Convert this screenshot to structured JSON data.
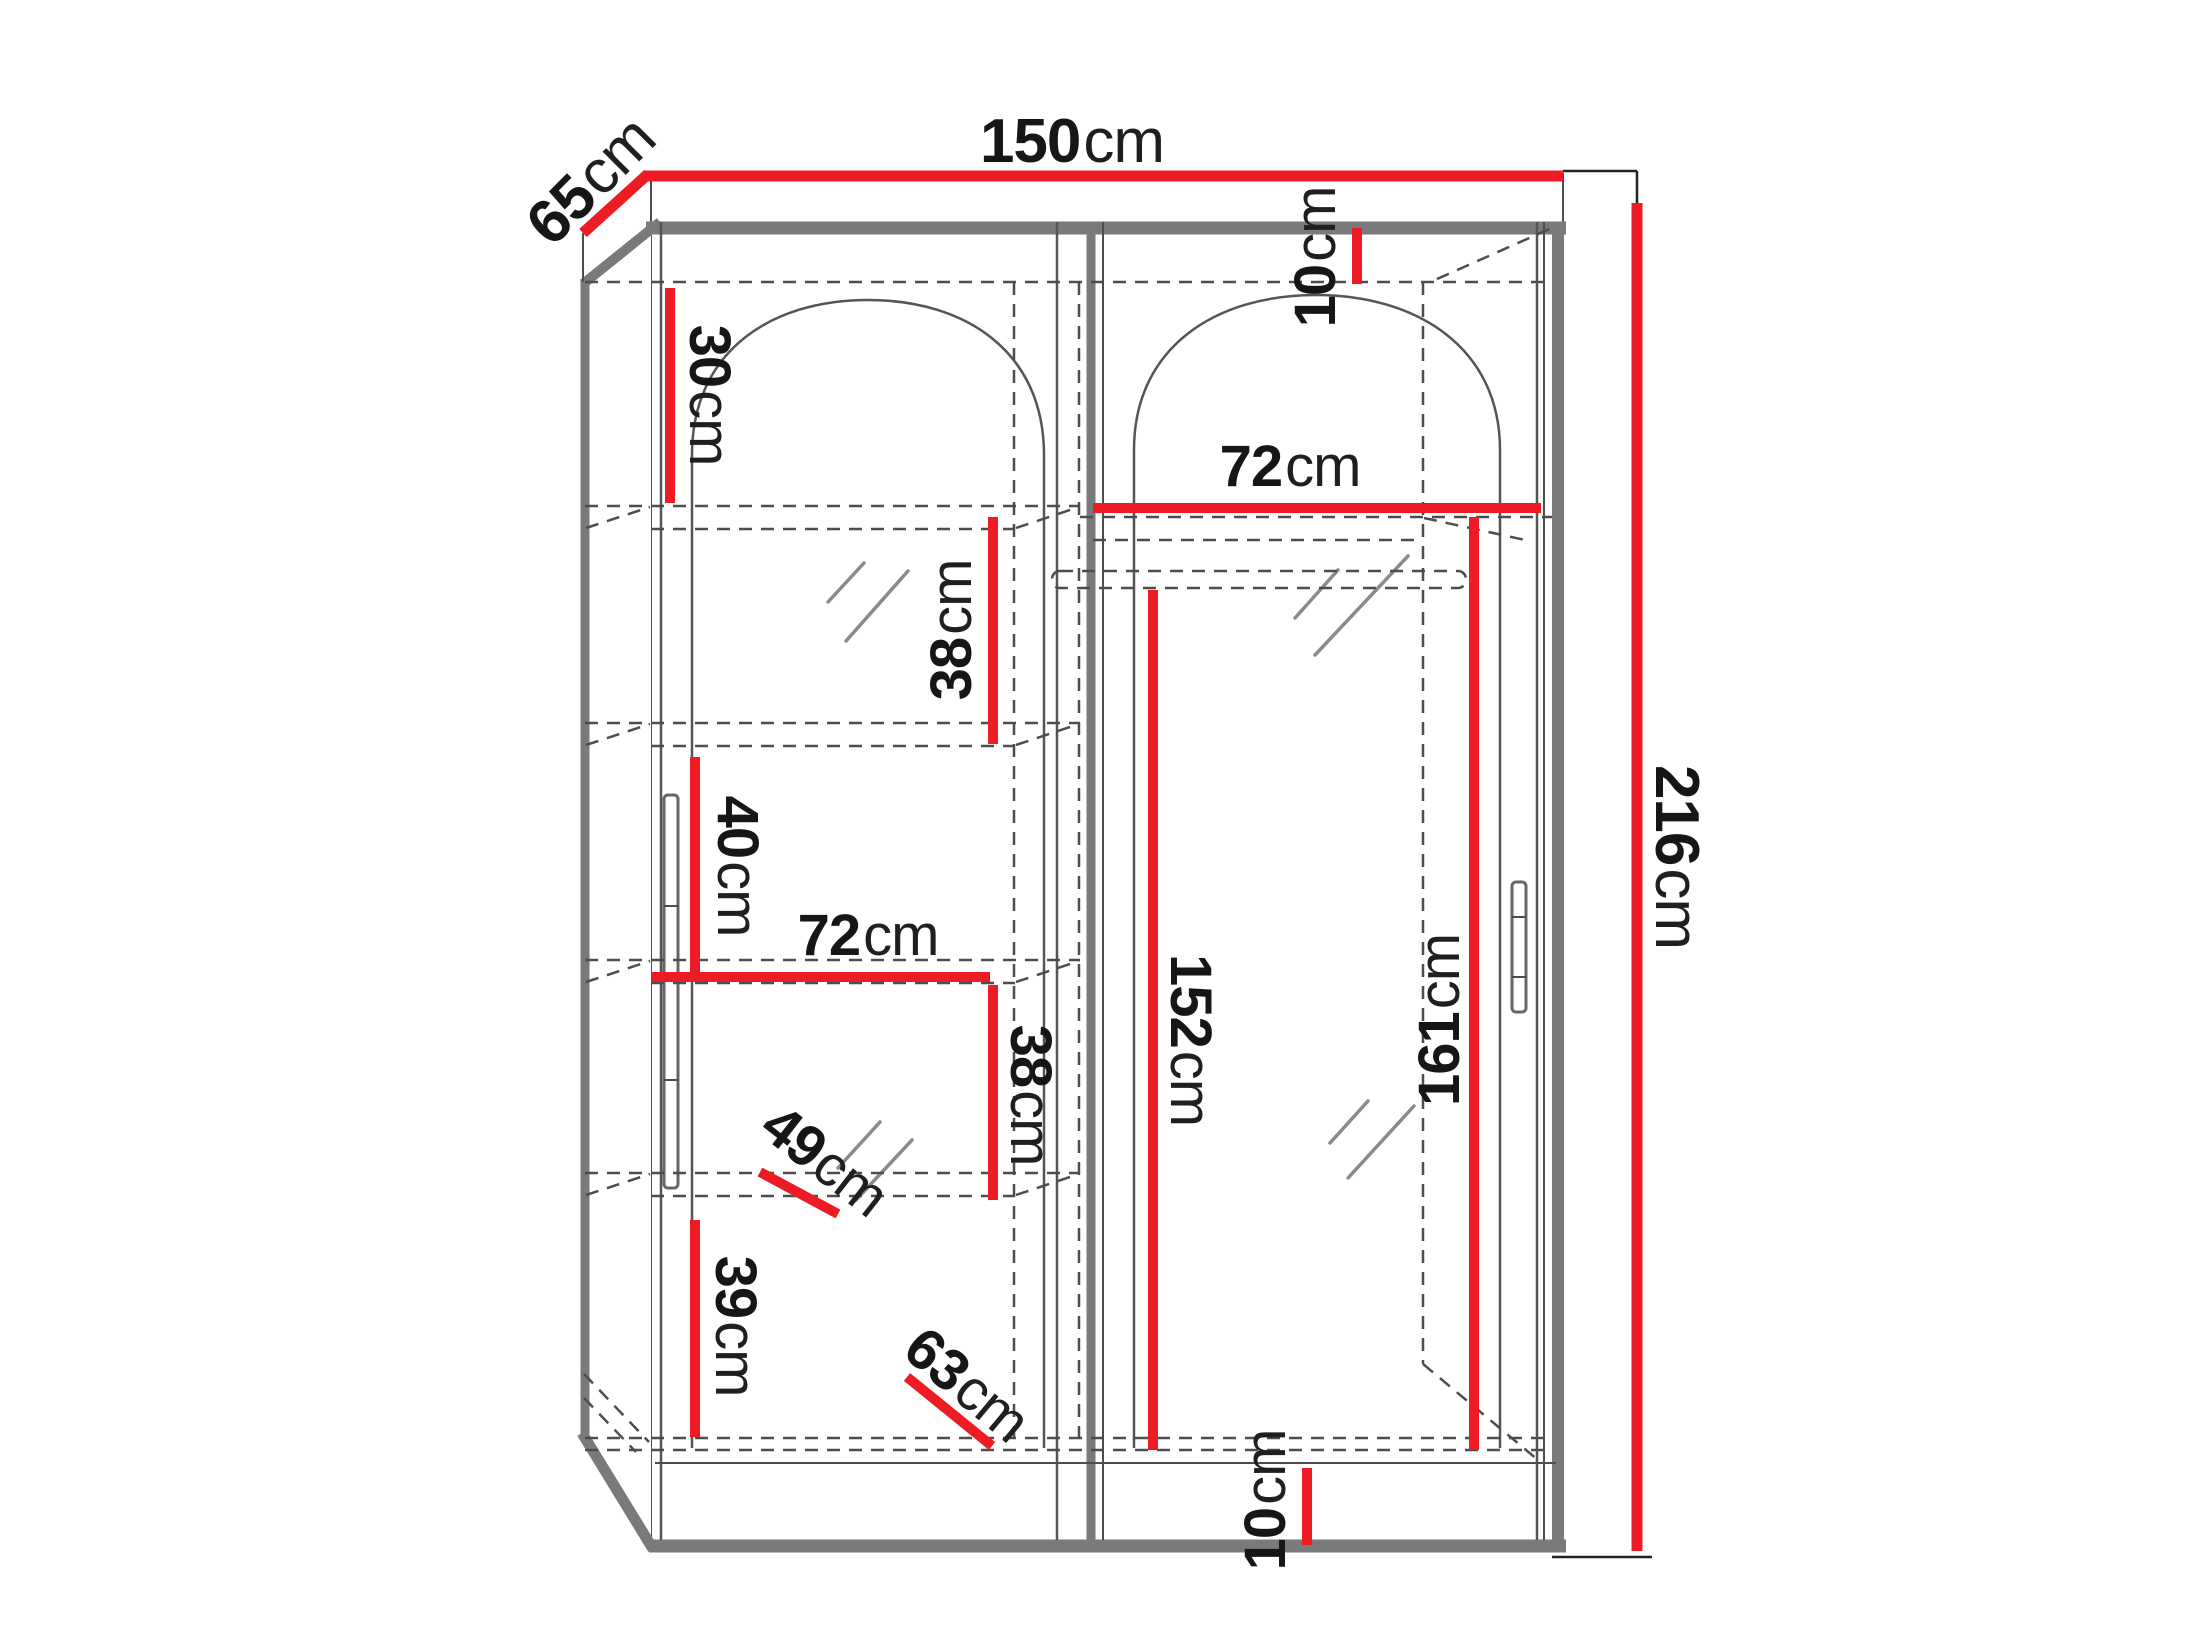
{
  "diagram": {
    "type": "furniture-dimension-drawing",
    "subject": "two-door sliding wardrobe with arched mirrors, internal shelving and hanging rail",
    "colors": {
      "dimension_line": "#ed1c24",
      "cabinet_edge": "#7a7a7a",
      "text": "#161616"
    },
    "dimensions": {
      "width": {
        "value": "150",
        "unit": "cm"
      },
      "depth": {
        "value": "65",
        "unit": "cm"
      },
      "height": {
        "value": "216",
        "unit": "cm"
      },
      "top_gap": {
        "value": "10",
        "unit": "cm"
      },
      "shelf_gap_30": {
        "value": "30",
        "unit": "cm"
      },
      "right_shelf_72": {
        "value": "72",
        "unit": "cm"
      },
      "shelf_gap_38_up": {
        "value": "38",
        "unit": "cm"
      },
      "shelf_gap_40": {
        "value": "40",
        "unit": "cm"
      },
      "left_shelf_72": {
        "value": "72",
        "unit": "cm"
      },
      "shelf_gap_38_low": {
        "value": "38",
        "unit": "cm"
      },
      "shelf_depth_49": {
        "value": "49",
        "unit": "cm"
      },
      "hanging_152": {
        "value": "152",
        "unit": "cm"
      },
      "right_height_161": {
        "value": "161",
        "unit": "cm"
      },
      "shelf_gap_39": {
        "value": "39",
        "unit": "cm"
      },
      "shelf_depth_63": {
        "value": "63",
        "unit": "cm"
      },
      "base_height_10": {
        "value": "10",
        "unit": "cm"
      }
    }
  }
}
